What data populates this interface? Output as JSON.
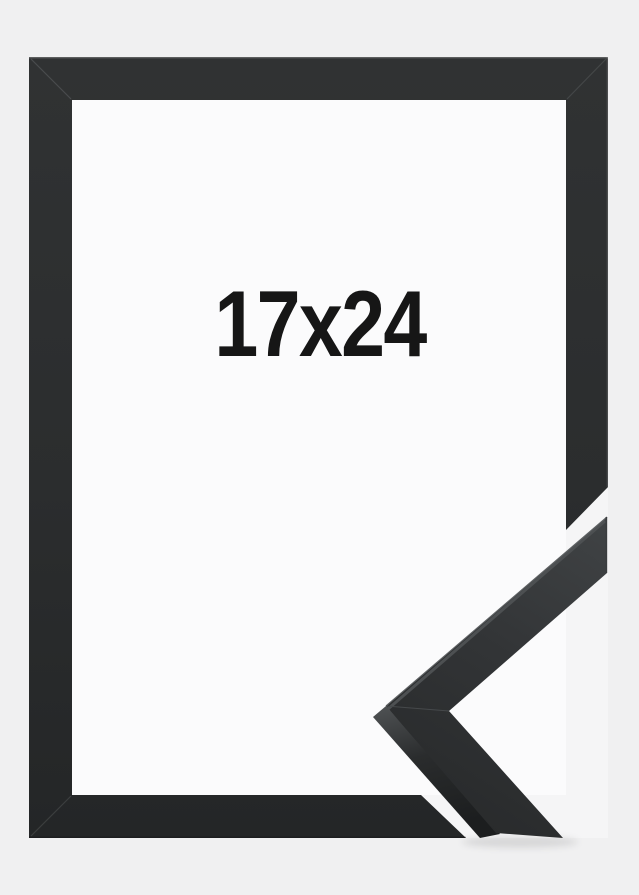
{
  "product_photo": {
    "size_label": "17x24",
    "subject": "black picture frame with mitered corner profile sample",
    "colors": {
      "background_outer": "#f0f0f1",
      "background_inner": "#fbfbfc",
      "background_cutout": "#f5f5f6",
      "frame_black": "#2c2e2f",
      "corner_sample_face": "#333638",
      "corner_sample_side": "#202223",
      "label_text": "#161616"
    }
  }
}
